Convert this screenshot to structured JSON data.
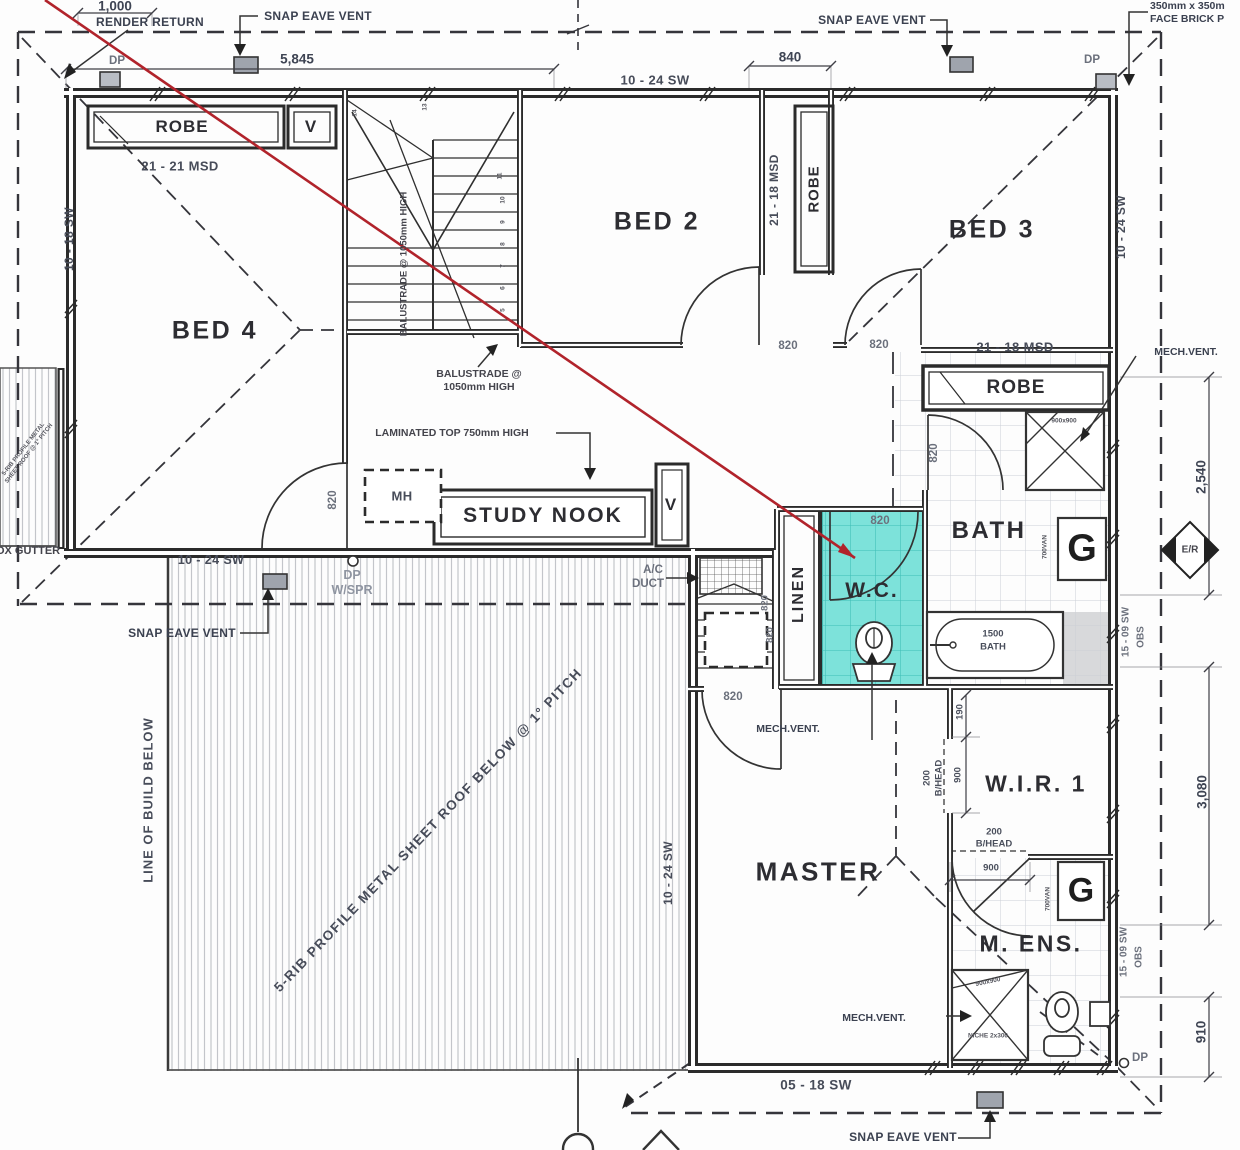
{
  "colors": {
    "wc_highlight": "#7de2da",
    "wc_grid": "#3dbdb5",
    "red_marker": "#b1232b",
    "tile_line": "#ccd0d6",
    "wall": "#2b2b2b"
  },
  "rooms": {
    "bed2": "BED 2",
    "bed3": "BED 3",
    "bed4": "BED 4",
    "master": "MASTER",
    "bath": "BATH",
    "wc": "W.C.",
    "mens": "M. ENS.",
    "wir1": "W.I.R. 1",
    "study_nook": "STUDY NOOK",
    "linen": "LINEN",
    "robe": "ROBE"
  },
  "fixtures": {
    "mh": "MH",
    "vent": "V",
    "vanity_icon": "G",
    "vanity_width": "700VAN",
    "tub_size": "1500",
    "tub_label": "BATH",
    "shower_size": "900x900",
    "niche": "NICHE 2x300"
  },
  "annotations": {
    "render_return": "RENDER RETURN",
    "snap_eave_vent": "SNAP EAVE VENT",
    "dp": "DP",
    "wspr": "W/SPR",
    "mech_vent": "MECH.VENT.",
    "ac": "A/C",
    "duct": "DUCT",
    "laminated_top": "LAMINATED TOP 750mm HIGH",
    "balustrade_1": "BALUSTRADE @",
    "balustrade_2": "1050mm HIGH",
    "balustrade_side": "BALUSTRADE @ 1050mm HIGH",
    "line_of_build": "LINE OF BUILD BELOW",
    "roof_note": "5-RIB PROFILE METAL SHEET ROOF BELOW @ 1° PITCH",
    "gutter_roof_note": "5-RIB PROFILE METAL SHEET ROOF @ 1° PITCH",
    "box_gutter": "BOX GUTTER",
    "face_brick_1": "350mm x 350m",
    "face_brick_2": "FACE BRICK P",
    "er_marker": "E/R",
    "bhead": "B/HEAD"
  },
  "openings": {
    "door": "820",
    "msd_2121": "21 - 21 MSD",
    "msd_2118": "21 - 18 MSD",
    "sw_1024": "10 - 24 SW",
    "sw_1018": "10 - 18 SW",
    "sw_1509": "15 - 09 SW",
    "sw_0518": "05 - 18 SW",
    "obs": "OBS"
  },
  "dimensions": {
    "d1000": "1,000",
    "d5845": "5,845",
    "d840": "840",
    "d2540": "2,540",
    "d3080": "3,080",
    "d910": "910",
    "d900": "900",
    "d190": "190",
    "d200": "200"
  },
  "stairs": {
    "n5": "5",
    "n6": "6",
    "n7": "7",
    "n8": "8",
    "n9": "9",
    "n10": "10",
    "n11": "11",
    "n13": "13",
    "n14": "14"
  }
}
